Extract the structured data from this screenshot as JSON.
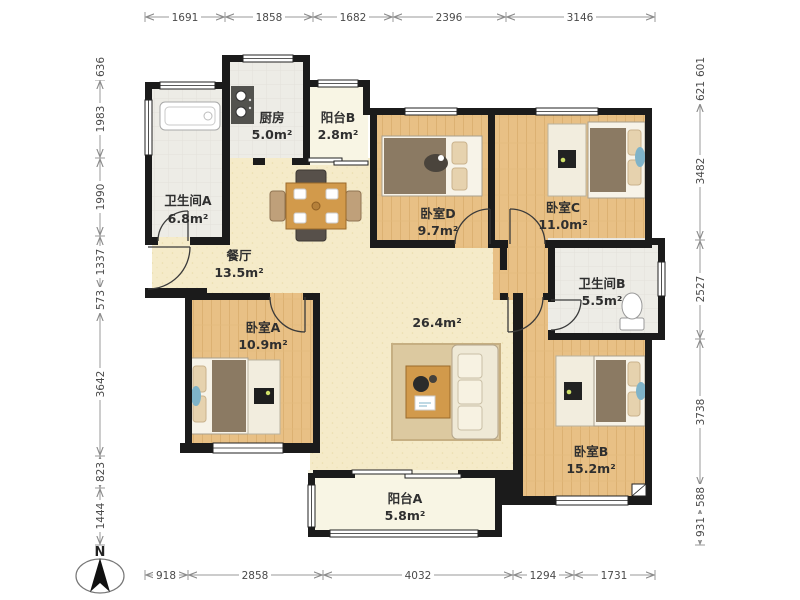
{
  "plan_title": "apartment-floor-plan",
  "compass": {
    "label": "N"
  },
  "colors": {
    "wall": "#1b1b1b",
    "wood_floor": "#e8c085",
    "living_floor": "#f5ebc9",
    "tile_floor": "#edece6",
    "balcony_floor": "#f8f5e4",
    "blanket": "#8b7a63",
    "accent_blue": "#7fb3c8"
  },
  "rooms": [
    {
      "id": "kitchen",
      "name": "厨房",
      "area": "5.0m²"
    },
    {
      "id": "balcony-b",
      "name": "阳台B",
      "area": "2.8m²"
    },
    {
      "id": "bath-a",
      "name": "卫生间A",
      "area": "6.8m²"
    },
    {
      "id": "dining",
      "name": "餐厅",
      "area": "13.5m²"
    },
    {
      "id": "bedroom-d",
      "name": "卧室D",
      "area": "9.7m²"
    },
    {
      "id": "bedroom-c",
      "name": "卧室C",
      "area": "11.0m²"
    },
    {
      "id": "bath-b",
      "name": "卫生间B",
      "area": "5.5m²"
    },
    {
      "id": "bedroom-a",
      "name": "卧室A",
      "area": "10.9m²"
    },
    {
      "id": "living",
      "name": "",
      "area": "26.4m²"
    },
    {
      "id": "bedroom-b",
      "name": "卧室B",
      "area": "15.2m²"
    },
    {
      "id": "balcony-a",
      "name": "阳台A",
      "area": "5.8m²"
    }
  ],
  "dimensions": {
    "top": [
      "1691",
      "1858",
      "1682",
      "2396",
      "3146"
    ],
    "bottom": [
      "918",
      "2858",
      "4032",
      "1294",
      "1731"
    ],
    "left": [
      "636",
      "1983",
      "1990",
      "1337",
      "573",
      "3642",
      "823",
      "1444"
    ],
    "right": [
      "601",
      "621",
      "3482",
      "2527",
      "3738",
      "588",
      "931"
    ]
  }
}
